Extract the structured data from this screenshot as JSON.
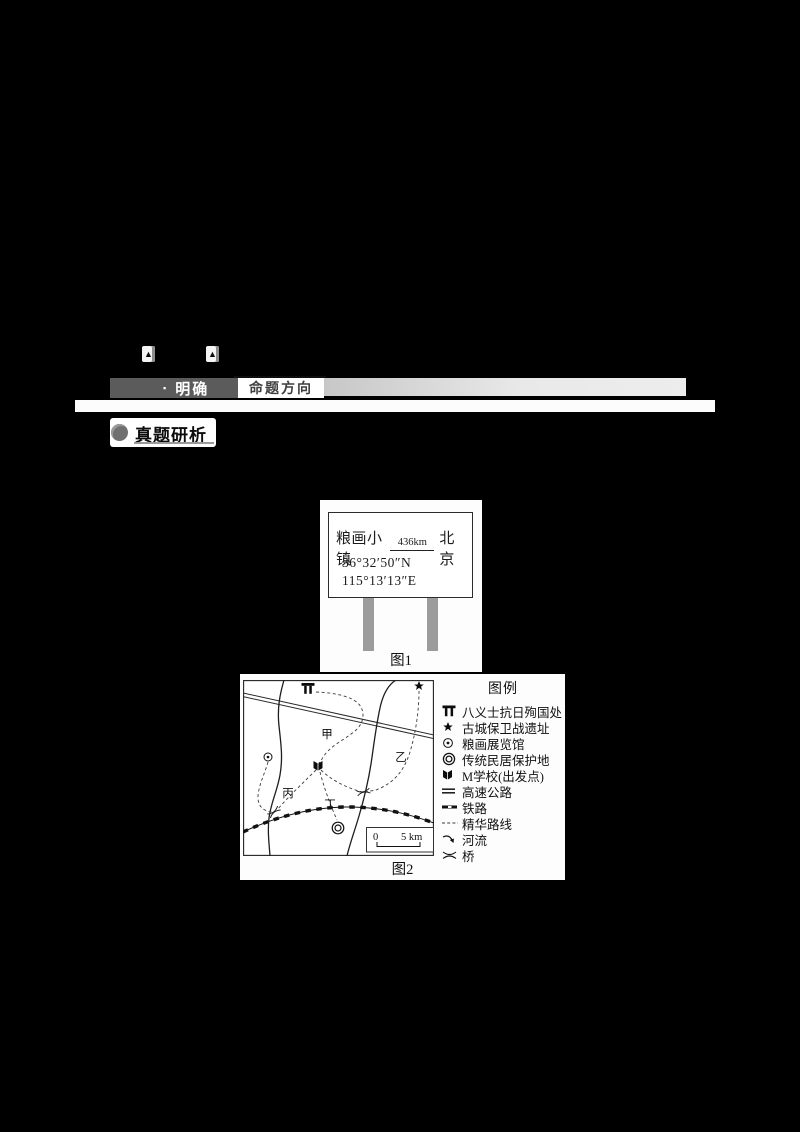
{
  "header": {
    "bullet": "▪",
    "tab_prefix": "明确",
    "tab_title": "命题方向",
    "section_title": "真题研析",
    "marker_glyph": "▲"
  },
  "figure1": {
    "caption": "图1",
    "sign": {
      "town": "粮画小镇",
      "distance": "436km",
      "city": "北京",
      "latitude": "36°32′50″N",
      "longitude": "115°13′13″E"
    }
  },
  "figure2": {
    "caption": "图2",
    "map_labels": {
      "jia": "甲",
      "yi": "乙",
      "bing": "丙",
      "ding": "丁"
    },
    "scale": {
      "zero": "0",
      "five": "5 km"
    },
    "legend": {
      "title": "图例",
      "items": [
        {
          "icon": "memorial-gate-icon",
          "label": "八义士抗日殉国处"
        },
        {
          "icon": "star-icon",
          "label": "古城保卫战遗址"
        },
        {
          "icon": "circle-dot-icon",
          "label": "粮画展览馆"
        },
        {
          "icon": "double-circle-icon",
          "label": "传统民居保护地"
        },
        {
          "icon": "open-book-icon",
          "label": "M学校(出发点)"
        },
        {
          "icon": "double-line-icon",
          "label": "高速公路"
        },
        {
          "icon": "railway-line-icon",
          "label": "铁路"
        },
        {
          "icon": "dashed-line-icon",
          "label": "精华路线"
        },
        {
          "icon": "river-arrow-icon",
          "label": "河流"
        },
        {
          "icon": "bridge-icon",
          "label": "桥"
        }
      ]
    }
  },
  "colors": {
    "page_background": "#000000",
    "panel_background": "#fdfdfd",
    "header_dark_bar": "#5b5b5b",
    "header_light_bar": "#d9d9d9",
    "post_gray": "#9c9c9c",
    "ink": "#1c1c1c"
  }
}
